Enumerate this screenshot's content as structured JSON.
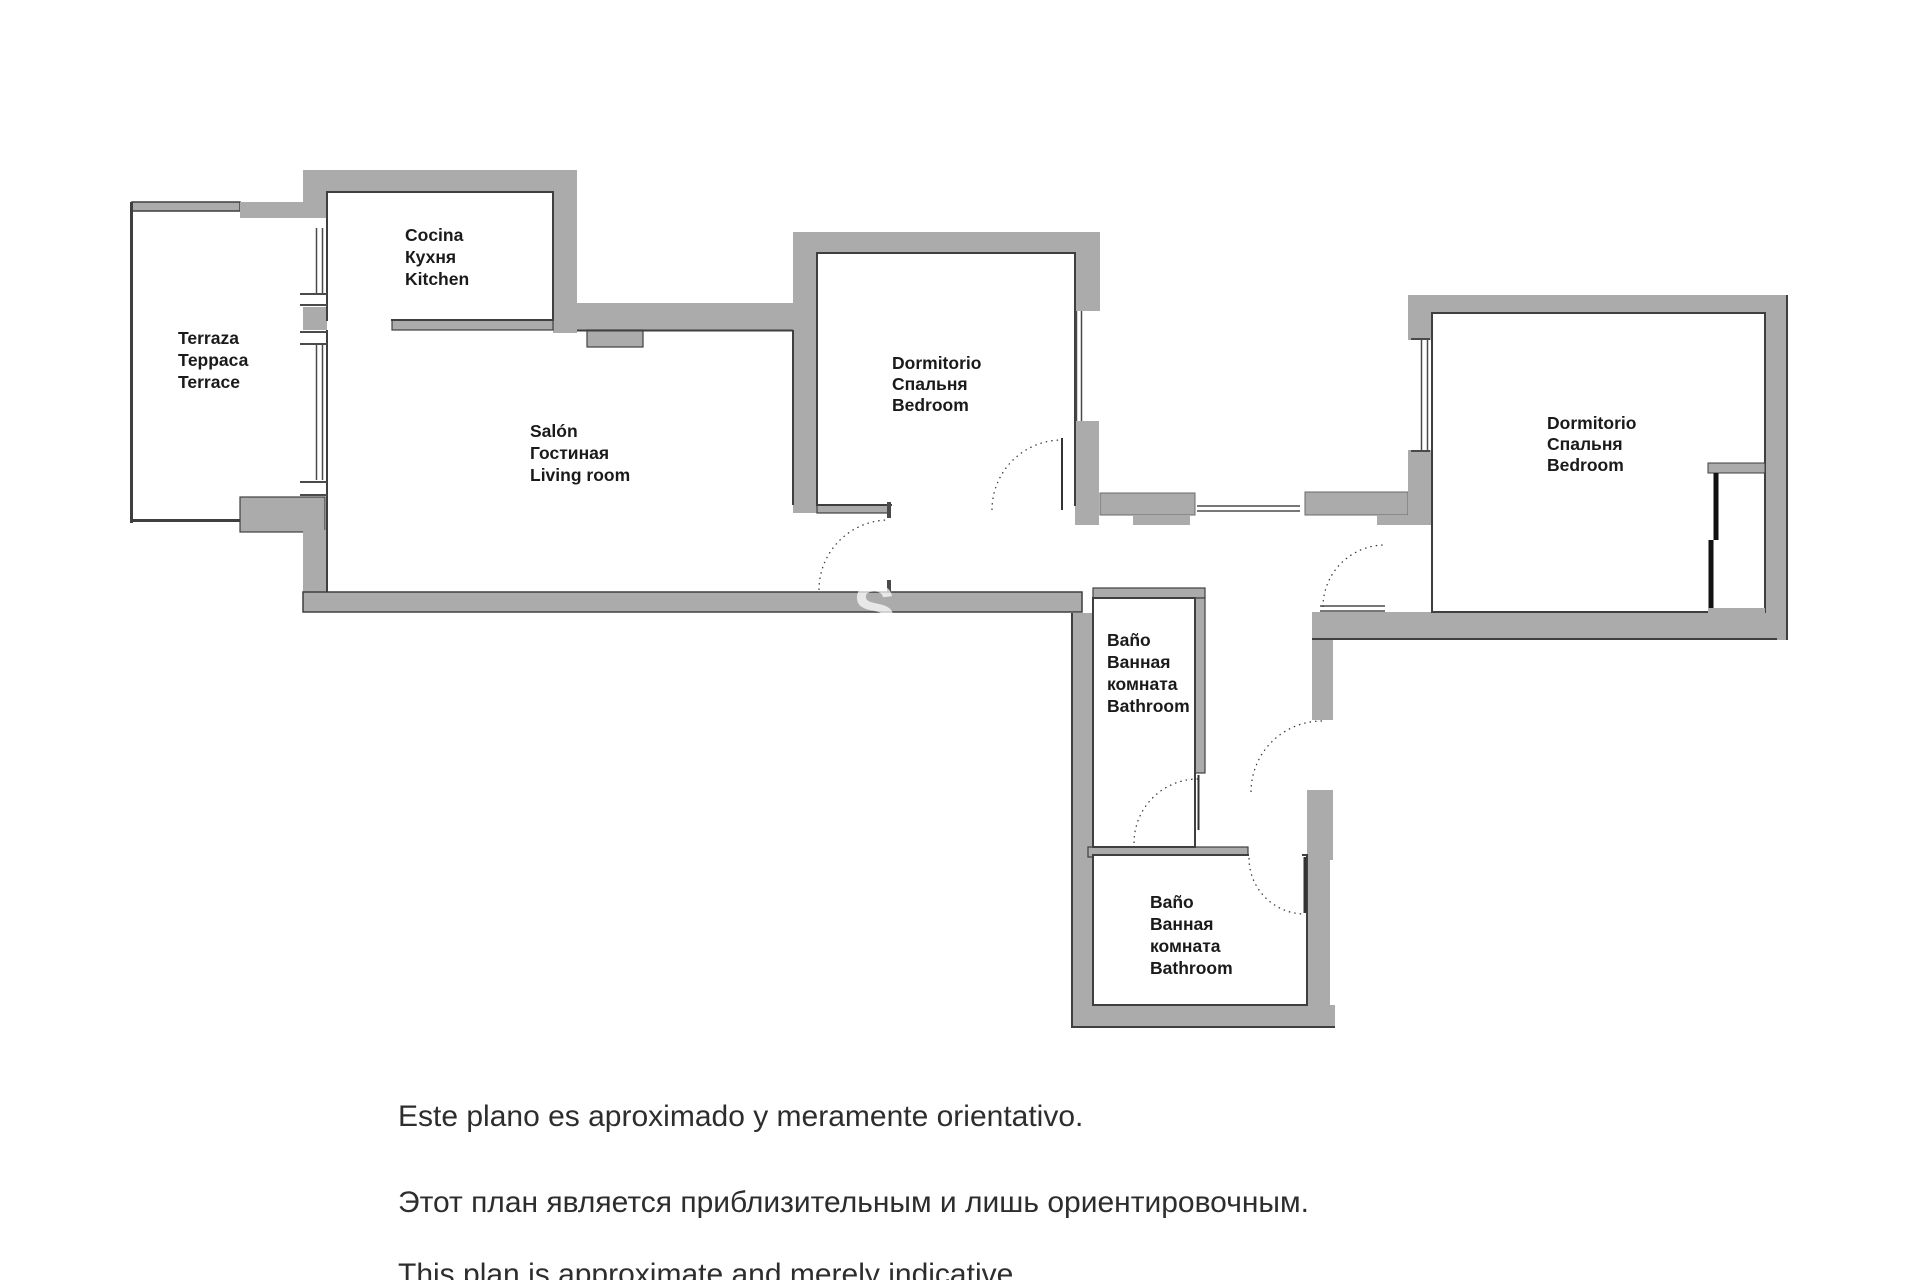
{
  "rooms": {
    "terrace": {
      "lines": [
        "Terraza",
        "Терраса",
        "Terrace"
      ]
    },
    "kitchen": {
      "lines": [
        "Cocina",
        "Кухня",
        "Kitchen"
      ]
    },
    "living": {
      "lines": [
        "Salón",
        "Гостиная",
        "Living room"
      ]
    },
    "bedroom1": {
      "lines": [
        "Dormitorio",
        "Спальня",
        "Bedroom"
      ]
    },
    "bedroom2": {
      "lines": [
        "Dormitorio",
        "Спальня",
        "Bedroom"
      ]
    },
    "bathroom1": {
      "lines": [
        "Baño",
        "Ванная",
        "комната",
        "Bathroom"
      ]
    },
    "bathroom2": {
      "lines": [
        "Baño",
        "Ванная",
        "комната",
        "Bathroom"
      ]
    }
  },
  "disclaimer": {
    "es": "Este plano es aproximado y meramente orientativo.",
    "ru": "Этот план является приблизительным и лишь ориентировочным.",
    "en": "This plan is approximate and merely indicative."
  },
  "watermark": "S",
  "colors": {
    "wall": "#ababab",
    "outline": "#3f3f3f",
    "label": "#1a1a1a",
    "disclaimer_text": "#2d2d2d"
  }
}
